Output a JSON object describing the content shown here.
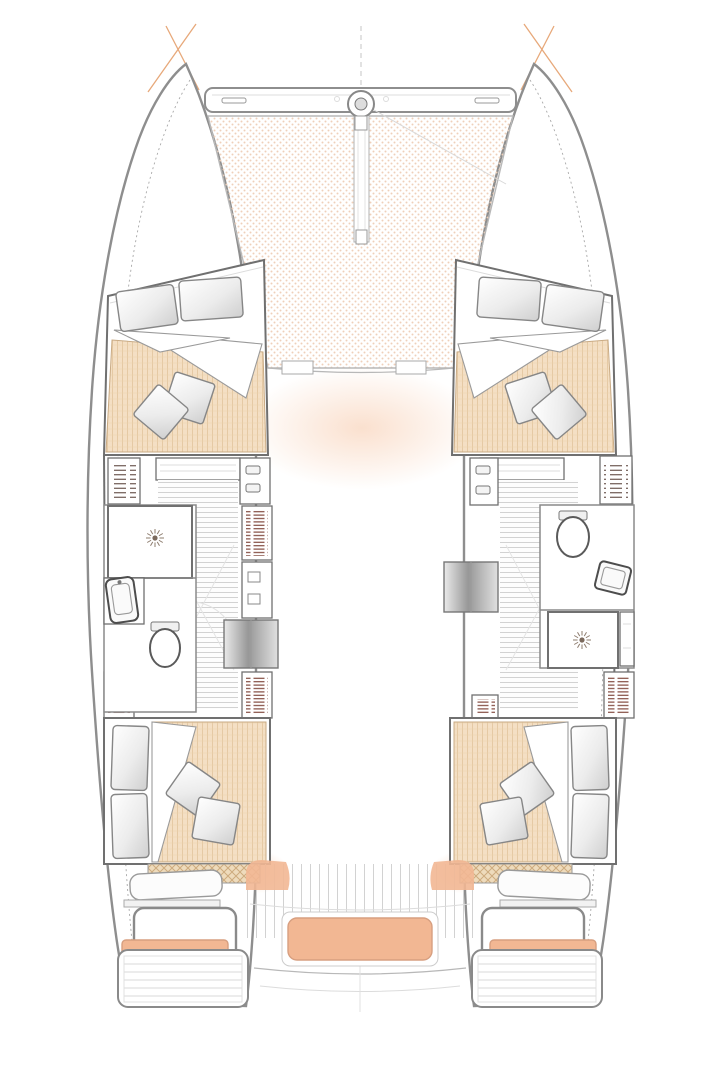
{
  "diagram": {
    "type": "catamaran-floor-plan",
    "view": "top-down-interior-deck-plan",
    "layout": "4-double-cabins-2-heads-bow-trampoline-aft-cockpit",
    "areas": [
      {
        "name": "bow-crossbeam",
        "fixtures": [
          "anchor-roller",
          "bowsprit",
          "bridle-line",
          "handle-slot",
          "handle-slot"
        ]
      },
      {
        "name": "trampoline",
        "fixtures": [
          "safety-net",
          "deck-hatch",
          "deck-hatch"
        ]
      },
      {
        "name": "forward-cabin-port",
        "fixtures": [
          "double-berth",
          "pillow",
          "pillow",
          "duvet",
          "throw-pillow",
          "throw-pillow",
          "bedside-shelf"
        ]
      },
      {
        "name": "forward-cabin-starboard",
        "fixtures": [
          "double-berth",
          "pillow",
          "pillow",
          "duvet",
          "throw-pillow",
          "throw-pillow",
          "bedside-shelf"
        ]
      },
      {
        "name": "head-port",
        "fixtures": [
          "shower",
          "shower-drain",
          "sink",
          "toilet"
        ]
      },
      {
        "name": "head-starboard",
        "fixtures": [
          "toilet",
          "sink",
          "shower",
          "shower-drain",
          "cabinet"
        ]
      },
      {
        "name": "corridor-port",
        "fixtures": [
          "companionway-steps",
          "wardrobe-louver",
          "locker",
          "locker",
          "shelf-locker"
        ]
      },
      {
        "name": "corridor-starboard",
        "fixtures": [
          "companionway-steps",
          "wardrobe-louver",
          "locker",
          "shelf-locker"
        ]
      },
      {
        "name": "aft-cabin-port",
        "fixtures": [
          "double-berth",
          "pillow",
          "pillow",
          "duvet",
          "throw-pillow",
          "throw-pillow",
          "engine-hatch"
        ]
      },
      {
        "name": "aft-cabin-starboard",
        "fixtures": [
          "double-berth",
          "pillow",
          "pillow",
          "duvet",
          "throw-pillow",
          "throw-pillow",
          "engine-hatch"
        ]
      },
      {
        "name": "aft-cockpit",
        "fixtures": [
          "seat-port",
          "seat-cushion-port",
          "footrest-pads-port",
          "seat-starboard",
          "seat-cushion-starboard",
          "footrest-pads-starboard",
          "center-bench-cushion",
          "side-step-port",
          "side-step-starboard",
          "deck-planks"
        ]
      },
      {
        "name": "swim-platform-port",
        "fixtures": [
          "transom-steps"
        ]
      },
      {
        "name": "swim-platform-starboard",
        "fixtures": [
          "transom-steps"
        ]
      }
    ],
    "colors": {
      "hull_line": "#8e8e8e",
      "wall_line": "#707070",
      "detail_line": "#b8b8b8",
      "faint_line": "#dcdcdc",
      "tramp_dot": "#efd0ba",
      "mattress_fill": "#f4dfc4",
      "mattress_line": "#e4c7a1",
      "cushion_fill": "#f2b793",
      "cushion_line": "#d79f80",
      "hatch_fill": "#eedbbc",
      "hatch_line": "#cdab7e",
      "louver_line": "#7e4337",
      "shelf_line": "#5f4a42",
      "glow": "#f5bd97",
      "mark_orange": "#e39a63"
    }
  }
}
